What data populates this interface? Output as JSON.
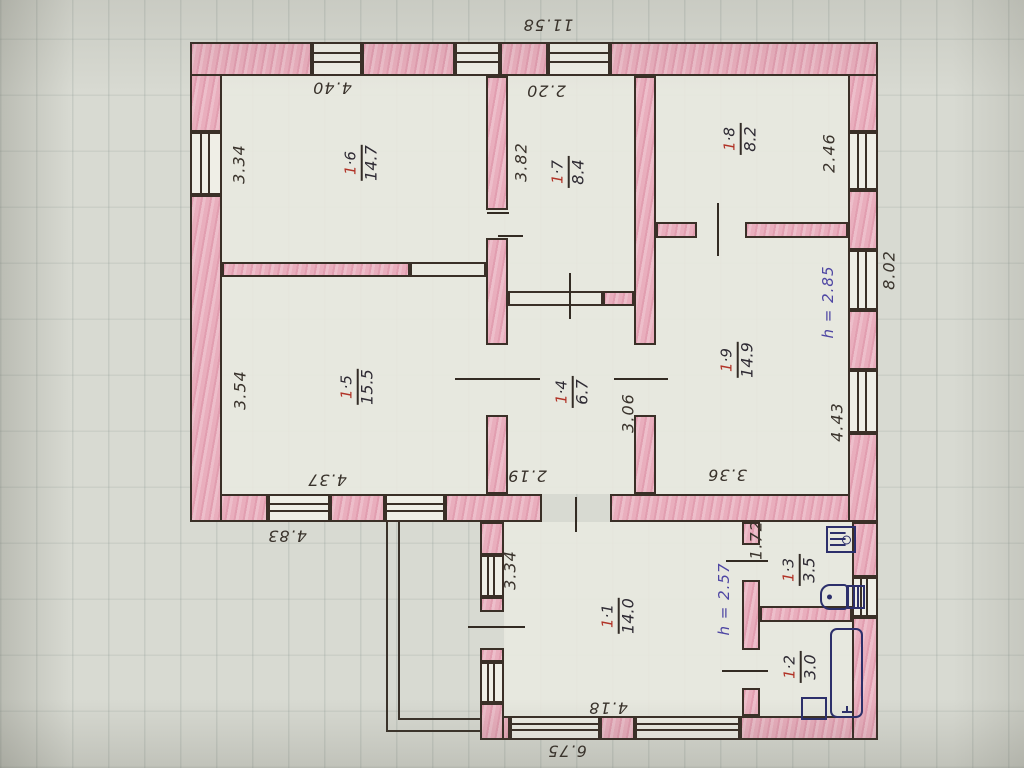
{
  "document": {
    "kind": "hand-drawn floor plan sketch",
    "ink_color": "#39322b",
    "wall_color": "#e9aebd",
    "accent_red": "#b13327",
    "accent_blue": "#4e46a3"
  },
  "rooms": [
    {
      "id": "1-1",
      "num_red": "1",
      "num_rest": "·1",
      "area": "14.0"
    },
    {
      "id": "1-2",
      "num_red": "1",
      "num_rest": "·2",
      "area": "3.0"
    },
    {
      "id": "1-3",
      "num_red": "1",
      "num_rest": "·3",
      "area": "3.5"
    },
    {
      "id": "1-4",
      "num_red": "1",
      "num_rest": "·4",
      "area": "6.7"
    },
    {
      "id": "1-5",
      "num_red": "1",
      "num_rest": "·5",
      "area": "15.5"
    },
    {
      "id": "1-6",
      "num_red": "1",
      "num_rest": "·6",
      "area": "14.7"
    },
    {
      "id": "1-7",
      "num_red": "1",
      "num_rest": "·7",
      "area": "8.4"
    },
    {
      "id": "1-8",
      "num_red": "1",
      "num_rest": "·8",
      "area": "8.2"
    },
    {
      "id": "1-9",
      "num_red": "1",
      "num_rest": "·9",
      "area": "14.9"
    }
  ],
  "heights": {
    "main": "h = 2.85",
    "annex": "h = 2.57"
  },
  "dimensions": {
    "top_total": "11.58",
    "r16_w": "4.40",
    "r17_w": "2.20",
    "r16_h": "3.34",
    "r15_h": "3.54",
    "r15_w": "4.37",
    "annex_left": "4.83",
    "r17_h": "3.82",
    "r14_w": "2.19",
    "r14_h": "3.06",
    "r18_h": "2.46",
    "right_total": "8.02",
    "r19_h": "4.43",
    "r19_w": "3.36",
    "r13_h": "1.72",
    "r11_h": "3.34",
    "r11_w": "4.18",
    "annex_total": "6.75"
  },
  "fixtures": [
    "water-heater",
    "toilet",
    "bathtub",
    "sink"
  ]
}
